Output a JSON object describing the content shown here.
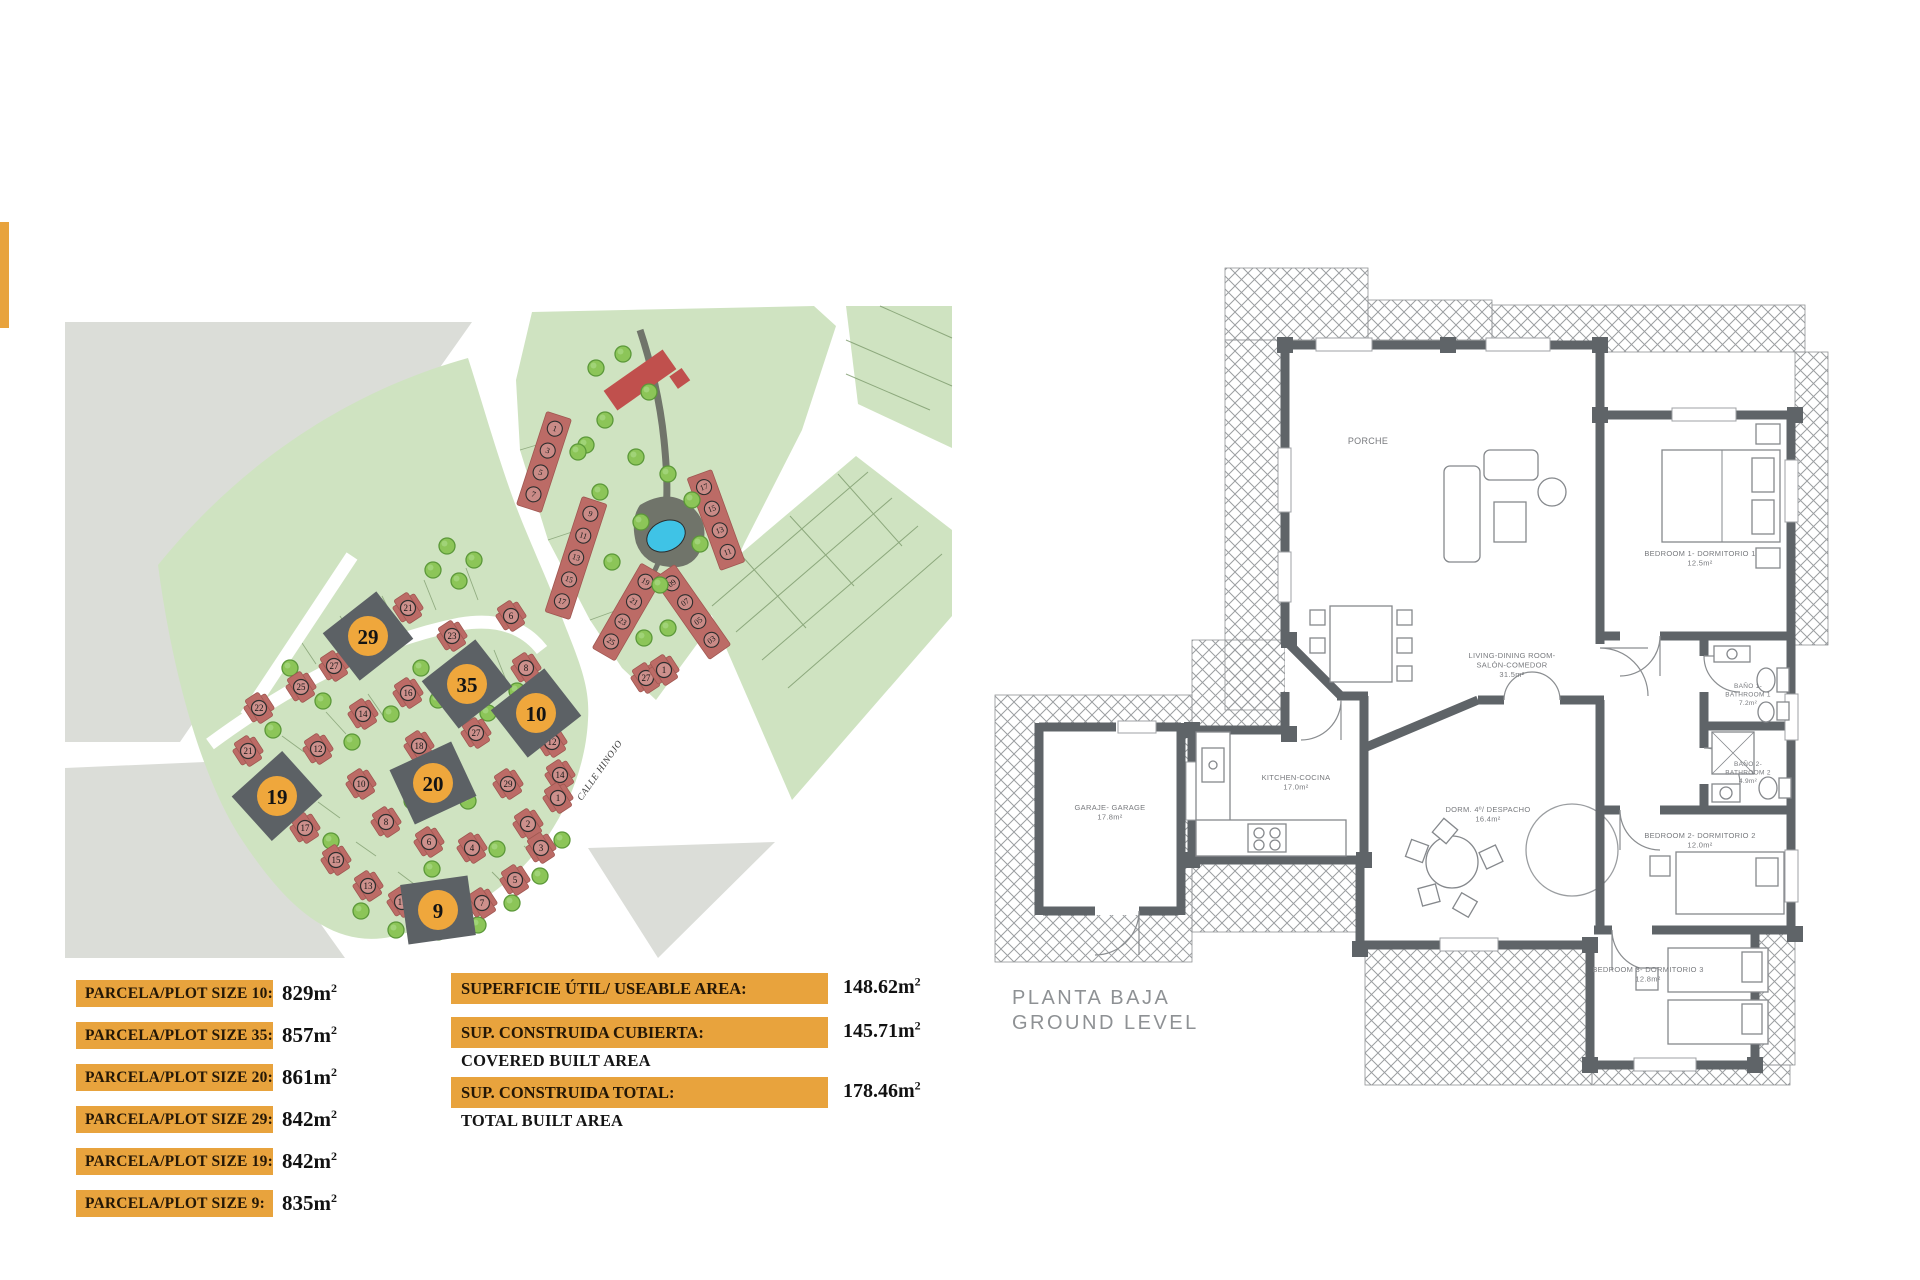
{
  "accent": {
    "orange": "#E8A33D"
  },
  "map": {
    "street_label": "CALLE HINOJO",
    "colors": {
      "green": "#CFE3C1",
      "green_line": "#7C9A6B",
      "gray": "#DBDDD8",
      "house": "#BC6B66",
      "house_edge": "#9F5751",
      "plot_dark": "#5C6165",
      "circle_orange": "#EFA73C",
      "tree": "#8CC558",
      "tree_edge": "#5B9839",
      "tree_light": "#A8D985",
      "pool": "#3FC3E6",
      "pool_deck": "#70746A",
      "building_red": "#C0504D"
    },
    "highlight_plots": [
      {
        "num": "29",
        "x": 368,
        "y": 636,
        "rot": -38
      },
      {
        "num": "35",
        "x": 467,
        "y": 684,
        "rot": -38
      },
      {
        "num": "10",
        "x": 536,
        "y": 713,
        "rot": -38
      },
      {
        "num": "20",
        "x": 433,
        "y": 783,
        "rot": -25
      },
      {
        "num": "19",
        "x": 277,
        "y": 796,
        "rot": -42
      },
      {
        "num": "9",
        "x": 438,
        "y": 910,
        "rot": -8
      }
    ],
    "houses": [
      {
        "n": "21",
        "x": 408,
        "y": 608
      },
      {
        "n": "27",
        "x": 334,
        "y": 666
      },
      {
        "n": "25",
        "x": 301,
        "y": 687
      },
      {
        "n": "22",
        "x": 259,
        "y": 708
      },
      {
        "n": "21",
        "x": 248,
        "y": 751
      },
      {
        "n": "23",
        "x": 452,
        "y": 636
      },
      {
        "n": "6",
        "x": 511,
        "y": 616
      },
      {
        "n": "8",
        "x": 526,
        "y": 668
      },
      {
        "n": "16",
        "x": 408,
        "y": 693
      },
      {
        "n": "14",
        "x": 363,
        "y": 714
      },
      {
        "n": "12",
        "x": 318,
        "y": 749
      },
      {
        "n": "10",
        "x": 361,
        "y": 784
      },
      {
        "n": "8",
        "x": 386,
        "y": 822
      },
      {
        "n": "6",
        "x": 429,
        "y": 842
      },
      {
        "n": "4",
        "x": 472,
        "y": 848
      },
      {
        "n": "18",
        "x": 419,
        "y": 746
      },
      {
        "n": "27",
        "x": 476,
        "y": 733
      },
      {
        "n": "29",
        "x": 508,
        "y": 784
      },
      {
        "n": "12",
        "x": 552,
        "y": 742
      },
      {
        "n": "14",
        "x": 560,
        "y": 775
      },
      {
        "n": "2",
        "x": 528,
        "y": 824
      },
      {
        "n": "17",
        "x": 305,
        "y": 828
      },
      {
        "n": "15",
        "x": 336,
        "y": 860
      },
      {
        "n": "13",
        "x": 368,
        "y": 886
      },
      {
        "n": "11",
        "x": 402,
        "y": 902
      },
      {
        "n": "7",
        "x": 482,
        "y": 903
      },
      {
        "n": "5",
        "x": 515,
        "y": 880
      },
      {
        "n": "3",
        "x": 541,
        "y": 848
      },
      {
        "n": "1",
        "x": 558,
        "y": 798
      },
      {
        "n": "27",
        "x": 646,
        "y": 678
      },
      {
        "n": "1",
        "x": 664,
        "y": 670
      }
    ],
    "strips": [
      {
        "x": 544,
        "y": 462,
        "rot": 18,
        "units": [
          "1",
          "3",
          "5",
          "7"
        ]
      },
      {
        "x": 576,
        "y": 558,
        "rot": 18,
        "units": [
          "9",
          "11",
          "13",
          "15",
          "17"
        ]
      },
      {
        "x": 628,
        "y": 612,
        "rot": 30,
        "units": [
          "19",
          "21",
          "23",
          "25"
        ]
      },
      {
        "x": 716,
        "y": 520,
        "rot": -20,
        "units": [
          "17",
          "15",
          "13",
          "11"
        ]
      },
      {
        "x": 692,
        "y": 612,
        "rot": -35,
        "units": [
          "09",
          "07",
          "05",
          "03"
        ]
      }
    ],
    "trees": [
      [
        290,
        668
      ],
      [
        273,
        730
      ],
      [
        323,
        701
      ],
      [
        352,
        742
      ],
      [
        391,
        714
      ],
      [
        421,
        668
      ],
      [
        438,
        700
      ],
      [
        488,
        713
      ],
      [
        517,
        691
      ],
      [
        544,
        714
      ],
      [
        300,
        801
      ],
      [
        331,
        841
      ],
      [
        361,
        911
      ],
      [
        396,
        930
      ],
      [
        438,
        932
      ],
      [
        478,
        925
      ],
      [
        512,
        903
      ],
      [
        540,
        876
      ],
      [
        562,
        840
      ],
      [
        412,
        801
      ],
      [
        468,
        801
      ],
      [
        497,
        849
      ],
      [
        432,
        869
      ],
      [
        447,
        546
      ],
      [
        474,
        560
      ],
      [
        433,
        570
      ],
      [
        459,
        581
      ],
      [
        596,
        368
      ],
      [
        623,
        354
      ],
      [
        649,
        392
      ],
      [
        605,
        420
      ],
      [
        586,
        445
      ],
      [
        636,
        457
      ],
      [
        668,
        474
      ],
      [
        692,
        500
      ],
      [
        641,
        522
      ],
      [
        612,
        562
      ],
      [
        660,
        585
      ],
      [
        600,
        492
      ],
      [
        578,
        452
      ],
      [
        700,
        544
      ],
      [
        644,
        638
      ],
      [
        668,
        628
      ]
    ]
  },
  "legend": {
    "unit": "m",
    "sup": "2",
    "plots": [
      {
        "label": "PARCELA/PLOT SIZE 10:",
        "value": "829"
      },
      {
        "label": "PARCELA/PLOT SIZE 35:",
        "value": "857"
      },
      {
        "label": "PARCELA/PLOT SIZE 20:",
        "value": "861"
      },
      {
        "label": "PARCELA/PLOT SIZE 29:",
        "value": "842"
      },
      {
        "label": "PARCELA/PLOT SIZE 19:",
        "value": "842"
      },
      {
        "label": "PARCELA/PLOT SIZE 9:",
        "value": "835"
      }
    ],
    "areas": [
      {
        "label": "SUPERFICIE ÚTIL/ USEABLE AREA:",
        "value": "148.62",
        "sublabel": ""
      },
      {
        "label": "SUP. CONSTRUIDA CUBIERTA:",
        "value": "145.71",
        "sublabel": "COVERED BUILT AREA"
      },
      {
        "label": "SUP. CONSTRUIDA TOTAL:",
        "value": "178.46",
        "sublabel": "TOTAL BUILT AREA"
      }
    ]
  },
  "floorplan": {
    "title_line1": "PLANTA BAJA",
    "title_line2": "GROUND LEVEL",
    "rooms": [
      {
        "x": 1368,
        "y": 444,
        "size": 9,
        "lines": [
          "PORCHE"
        ]
      },
      {
        "x": 1512,
        "y": 658,
        "size": 7.5,
        "lines": [
          "LIVING-DINING ROOM-",
          "SALÓN-COMEDOR",
          "31.5m²"
        ]
      },
      {
        "x": 1296,
        "y": 780,
        "size": 7.5,
        "lines": [
          "KITCHEN-COCINA",
          "17.0m²"
        ]
      },
      {
        "x": 1488,
        "y": 812,
        "size": 7.5,
        "lines": [
          "DORM. 4º/ DESPACHO",
          "16.4m²"
        ]
      },
      {
        "x": 1110,
        "y": 810,
        "size": 7.5,
        "lines": [
          "GARAJE- GARAGE",
          "17.8m²"
        ]
      },
      {
        "x": 1700,
        "y": 556,
        "size": 7.5,
        "lines": [
          "BEDROOM 1- DORMITORIO 1",
          "12.5m²"
        ]
      },
      {
        "x": 1748,
        "y": 688,
        "size": 6.5,
        "lines": [
          "BAÑO 1-",
          "BATHROOM 1",
          "7.2m²"
        ]
      },
      {
        "x": 1748,
        "y": 766,
        "size": 6.5,
        "lines": [
          "BAÑO 2-",
          "BATHROOM 2",
          "4.9m²"
        ]
      },
      {
        "x": 1700,
        "y": 838,
        "size": 7.5,
        "lines": [
          "BEDROOM 2- DORMITORIO 2",
          "12.0m²"
        ]
      },
      {
        "x": 1648,
        "y": 972,
        "size": 7.5,
        "lines": [
          "BEDROOM 3- DORMITORIO 3",
          "12.8m²"
        ]
      }
    ]
  }
}
